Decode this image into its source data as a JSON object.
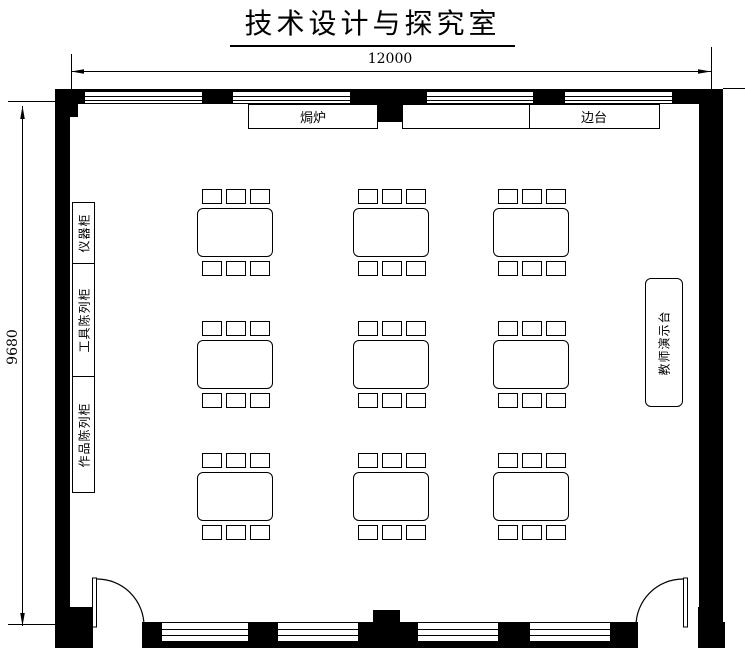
{
  "title": "技术设计与探究室",
  "dimensions": {
    "width_label": "12000",
    "height_label": "9680"
  },
  "fixtures": {
    "oven_label": "焗炉",
    "side_counter_label": "边台",
    "teacher_station_label": "教师演示台",
    "cabinets": [
      {
        "label": "仪器柜"
      },
      {
        "label": "工具陈列柜"
      },
      {
        "label": "作品陈列柜"
      }
    ]
  },
  "furniture": {
    "tables": {
      "rows": 3,
      "cols": 3,
      "stools_per_long_side": 3
    }
  },
  "doors": {
    "count": 2
  },
  "colors": {
    "line": "#000000",
    "background": "#ffffff"
  }
}
